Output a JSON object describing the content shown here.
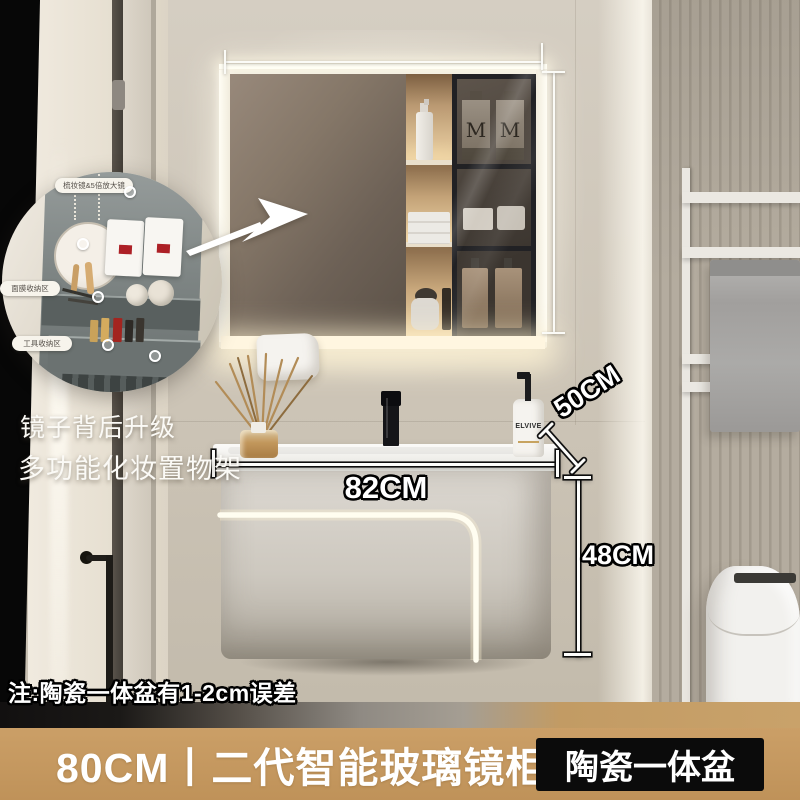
{
  "inset": {
    "labels": {
      "top": "梳妆镜&5倍放大镜",
      "middle": "面膜收纳区",
      "bottom": "工具收纳区"
    },
    "caption": {
      "line1": "镜子背后升级",
      "line2": "多功能化妆置物架"
    }
  },
  "dimensions": {
    "width": "82CM",
    "depth": "50CM",
    "height": "48CM"
  },
  "products": {
    "mirror_bottle_label": "M",
    "counter_bottle_label": "ELVIVE"
  },
  "note": "注:陶瓷一体盆有1-2cm误差",
  "banner": {
    "title": "80CM丨二代智能玻璃镜柜",
    "badge": "陶瓷一体盆"
  },
  "colors": {
    "banner_bg": "#c59a63",
    "badge_bg": "#0b0b0b",
    "text": "#ffffff"
  }
}
